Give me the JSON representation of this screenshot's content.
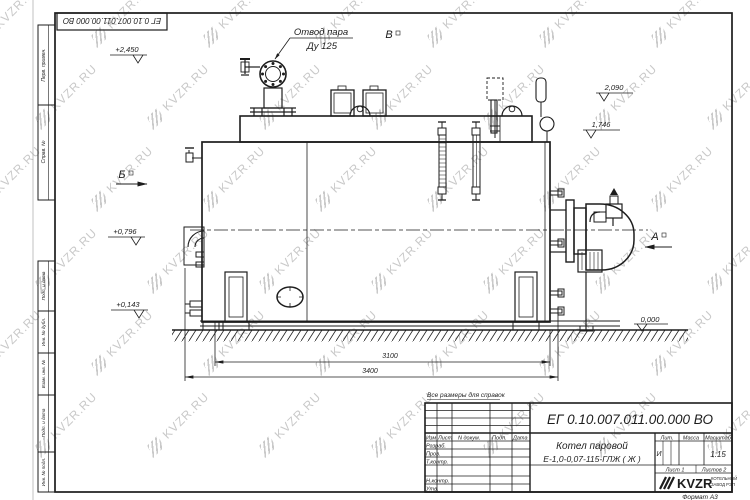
{
  "colors": {
    "ink": "#1d1d1d",
    "watermark": "#c9c9c9",
    "paper": "#ffffff"
  },
  "watermark": {
    "text": "KVZR.RU"
  },
  "stamp_top": {
    "doc_number": "ЕГ 0.10.007.011.00.000  ВО"
  },
  "side_strip": {
    "items": [
      "Перв. примен.",
      "Справ. №",
      "Подп. и дата",
      "Инв. № дубл.",
      "Взам. инв. №",
      "Подп. и дата",
      "Инв. № подл."
    ]
  },
  "drawing": {
    "callout": {
      "line1": "Отвод пара",
      "line2": "Ду 125"
    },
    "views": {
      "b": "Б",
      "v": "В",
      "a": "А"
    },
    "elevations": {
      "top": "+2,450",
      "right_upper": "2,090",
      "right_lower": "1,746",
      "left_upper": "+0,796",
      "left_lower": "+0,143",
      "ground": "0,000"
    },
    "dimensions": {
      "inner": "3100",
      "overall": "3400"
    },
    "note": "Все размеры для справок"
  },
  "title_block": {
    "doc_number": "ЕГ 0.10.007.011.00.000  ВО",
    "product_name_line1": "Котел паровой",
    "product_name_line2": "Е-1,0-0,07-115-ГЛЖ ( Ж )",
    "header": {
      "izm": "Изм",
      "list": "Лист",
      "ndoc": "N докум.",
      "podp": "Подп.",
      "data": "Дата"
    },
    "rows": [
      "Разраб.",
      "Пров.",
      "Т.контр.",
      "Н.контр.",
      "Утв."
    ],
    "lit_label": "Лит.",
    "lit_value": "И",
    "massa_label": "Масса",
    "masshtab_label": "Масштаб",
    "scale": "1:15",
    "sheet": "Лист 1",
    "sheets": "Листов 2",
    "logo": {
      "text": "KVZR",
      "sub1": "КОТЕЛЬНЫЙ",
      "sub2": "ЗАВОД РЭП"
    },
    "format": "Формат А3"
  }
}
